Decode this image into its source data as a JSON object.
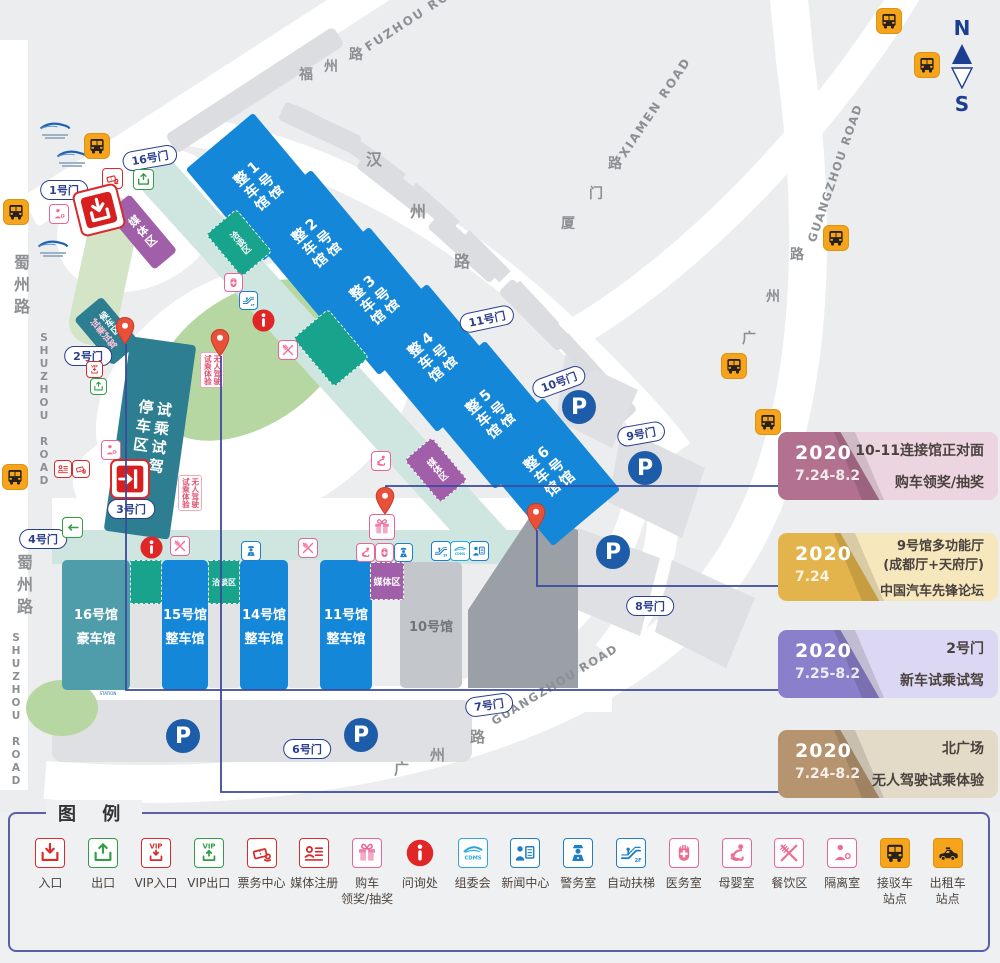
{
  "compass": {
    "n": "N",
    "s": "S"
  },
  "legend": {
    "title": "图 例",
    "items": [
      {
        "icon": "entrance",
        "label": "入口"
      },
      {
        "icon": "exit",
        "label": "出口"
      },
      {
        "icon": "vip-entrance",
        "label": "VIP入口"
      },
      {
        "icon": "vip-exit",
        "label": "VIP出口"
      },
      {
        "icon": "tickets",
        "label": "票务中心"
      },
      {
        "icon": "media-reg",
        "label": "媒体注册"
      },
      {
        "icon": "gift",
        "label": "购车\n领奖/抽奖"
      },
      {
        "icon": "info",
        "label": "问询处"
      },
      {
        "icon": "cdms",
        "label": "组委会"
      },
      {
        "icon": "news",
        "label": "新闻中心"
      },
      {
        "icon": "police",
        "label": "警务室"
      },
      {
        "icon": "escalator",
        "label": "自动扶梯"
      },
      {
        "icon": "medical",
        "label": "医务室"
      },
      {
        "icon": "mother-baby",
        "label": "母婴室"
      },
      {
        "icon": "dining",
        "label": "餐饮区"
      },
      {
        "icon": "isolation",
        "label": "隔离室"
      },
      {
        "icon": "shuttle-bus",
        "label": "接驳车\n站点"
      },
      {
        "icon": "taxi",
        "label": "出租车\n站点"
      }
    ]
  },
  "callouts": [
    {
      "year": "2020",
      "date": "7.24-8.2",
      "lines": [
        "10-11连接馆正对面",
        "购车领奖/抽奖"
      ],
      "dark": "#b1718f",
      "light": "#ecd4e1",
      "y": 432
    },
    {
      "year": "2020",
      "date": "7.24",
      "lines": [
        "9号馆多功能厅",
        "(成都厅+天府厅)",
        "中国汽车先锋论坛"
      ],
      "dark": "#e2b44b",
      "light": "#f7e7bd",
      "y": 533
    },
    {
      "year": "2020",
      "date": "7.25-8.2",
      "lines": [
        "2号门",
        "新车试乘试驾"
      ],
      "dark": "#8a7fca",
      "light": "#dcd7f2",
      "y": 630
    },
    {
      "year": "2020",
      "date": "7.24-8.2",
      "lines": [
        "北广场",
        "无人驾驶试乘体验"
      ],
      "dark": "#b5946f",
      "light": "#e4dac8",
      "y": 730
    }
  ],
  "map": {
    "roadLabels": [
      {
        "text": "FUZHOU ROAD",
        "x": 370,
        "y": 40,
        "rot": -33,
        "fs": 12,
        "ls": 2
      },
      {
        "text": "福",
        "x": 299,
        "y": 64,
        "fs": 14
      },
      {
        "text": "州",
        "x": 324,
        "y": 56,
        "fs": 14
      },
      {
        "text": "路",
        "x": 349,
        "y": 44,
        "fs": 14
      },
      {
        "text": "汉",
        "x": 366,
        "y": 146,
        "fs": 16
      },
      {
        "text": "州",
        "x": 410,
        "y": 198,
        "fs": 16
      },
      {
        "text": "路",
        "x": 454,
        "y": 248,
        "fs": 16
      },
      {
        "text": "厦",
        "x": 561,
        "y": 213,
        "fs": 14
      },
      {
        "text": "门",
        "x": 589,
        "y": 183,
        "fs": 14
      },
      {
        "text": "路",
        "x": 608,
        "y": 153,
        "fs": 14
      },
      {
        "text": "XIAMEN ROAD",
        "x": 628,
        "y": 146,
        "rot": -56,
        "fs": 12,
        "ls": 2
      },
      {
        "text": "路",
        "x": 790,
        "y": 244,
        "fs": 14
      },
      {
        "text": "州",
        "x": 766,
        "y": 286,
        "fs": 14
      },
      {
        "text": "广",
        "x": 742,
        "y": 328,
        "fs": 14
      },
      {
        "text": "GUANGZHOU ROAD",
        "x": 818,
        "y": 230,
        "rot": -71,
        "fs": 11.5,
        "ls": 1.5
      },
      {
        "text": "广",
        "x": 394,
        "y": 758,
        "fs": 15
      },
      {
        "text": "州",
        "x": 430,
        "y": 744,
        "fs": 15
      },
      {
        "text": "路",
        "x": 470,
        "y": 726,
        "fs": 15
      },
      {
        "text": "GUANGZHOU ROAD",
        "x": 496,
        "y": 714,
        "rot": -31,
        "fs": 11.5,
        "ls": 1.5
      },
      {
        "text": "蜀州路",
        "x": 8,
        "y": 254,
        "vertical": true,
        "fs": 16,
        "ls": 6
      },
      {
        "text": "SHUZHOU ROAD",
        "x": 38,
        "y": 332,
        "vertical": true,
        "upright": true,
        "fs": 10.5,
        "ls": 1
      },
      {
        "text": "蜀州路",
        "x": 11,
        "y": 554,
        "vertical": true,
        "fs": 16,
        "ls": 6
      },
      {
        "text": "SHUZHOU ROAD",
        "x": 10,
        "y": 632,
        "vertical": true,
        "upright": true,
        "fs": 10.5,
        "ls": 1
      }
    ],
    "gates": [
      {
        "label": "16号门",
        "x": 150,
        "y": 158,
        "rot": -10
      },
      {
        "label": "1号门",
        "x": 64,
        "y": 190,
        "rot": 0
      },
      {
        "label": "2号门",
        "x": 88,
        "y": 356,
        "rot": 0
      },
      {
        "label": "3号门",
        "x": 131,
        "y": 509,
        "rot": 0
      },
      {
        "label": "4号门",
        "x": 43,
        "y": 539,
        "rot": 0
      },
      {
        "label": "11号门",
        "x": 487,
        "y": 319,
        "rot": -12
      },
      {
        "label": "10号门",
        "x": 559,
        "y": 382,
        "rot": -20
      },
      {
        "label": "9号门",
        "x": 641,
        "y": 434,
        "rot": -10
      },
      {
        "label": "8号门",
        "x": 650,
        "y": 606,
        "rot": 0
      },
      {
        "label": "7号门",
        "x": 489,
        "y": 705,
        "rot": -8
      },
      {
        "label": "6号门",
        "x": 307,
        "y": 749,
        "rot": 0
      }
    ],
    "upperHalls": [
      {
        "name": "1号馆",
        "sub": "整车馆",
        "cx": 258,
        "cy": 187
      },
      {
        "name": "2号馆",
        "sub": "整车馆",
        "cx": 316,
        "cy": 244
      },
      {
        "name": "3号馆",
        "sub": "整车馆",
        "cx": 374,
        "cy": 301
      },
      {
        "name": "4号馆",
        "sub": "整车馆",
        "cx": 432,
        "cy": 358
      },
      {
        "name": "5号馆",
        "sub": "整车馆",
        "cx": 490,
        "cy": 415
      },
      {
        "name": "6号馆",
        "sub": "整车馆",
        "cx": 548,
        "cy": 472
      }
    ],
    "lowerHalls": [
      {
        "name": "16号馆",
        "sub": "豪车馆",
        "x": 62,
        "y": 560,
        "w": 68,
        "h": 130,
        "color": "#4f9dab"
      },
      {
        "name": "15号馆",
        "sub": "整车馆",
        "x": 162,
        "y": 560,
        "w": 46,
        "h": 130,
        "color": "#1587d8"
      },
      {
        "name": "14号馆",
        "sub": "整车馆",
        "x": 240,
        "y": 560,
        "w": 48,
        "h": 130,
        "color": "#1587d8"
      },
      {
        "name": "11号馆",
        "sub": "整车馆",
        "x": 320,
        "y": 560,
        "w": 52,
        "h": 130,
        "color": "#1587d8"
      },
      {
        "name": "10号馆",
        "sub": "",
        "x": 400,
        "y": 562,
        "w": 62,
        "h": 126,
        "color": "#c3c6ca",
        "tc": "#70757b"
      }
    ],
    "zones": [
      {
        "kind": "rot",
        "nm": "waiting-area",
        "cx": 107,
        "cy": 331,
        "w": 36,
        "h": 60,
        "rot": -40,
        "color": "#2e7e92",
        "cols": [
          "候车区",
          "试乘试驾"
        ],
        "colors": [
          "#ffffff",
          "#ffc2d6"
        ],
        "fs": 9
      },
      {
        "kind": "rot",
        "nm": "test-drive-parking",
        "cx": 150,
        "cy": 438,
        "w": 66,
        "h": 196,
        "rot": 8,
        "color": "#2e7e92",
        "cols": [
          "试乘试驾",
          "停车区"
        ],
        "fs": 15,
        "ls": 4
      },
      {
        "kind": "rot",
        "nm": "media-zone",
        "cx": 142,
        "cy": 232,
        "w": 30,
        "h": 74,
        "rot": -40,
        "color": "#a05fa8",
        "cols": [
          "媒体区"
        ],
        "fs": 11,
        "ls": 2
      },
      {
        "kind": "rot",
        "nm": "talks-zone",
        "cx": 239,
        "cy": 243,
        "w": 40,
        "h": 56,
        "rot": -40,
        "color": "#17a38c",
        "dashed": true,
        "cols": [
          "洽谈区"
        ],
        "fs": 9
      },
      {
        "kind": "rot",
        "nm": "talks-zone",
        "cx": 331,
        "cy": 348,
        "w": 46,
        "h": 64,
        "rot": -40,
        "color": "#17a38c",
        "dashed": true,
        "cols": [],
        "fs": 9
      },
      {
        "kind": "rot",
        "nm": "media-zone",
        "cx": 436,
        "cy": 470,
        "w": 36,
        "h": 56,
        "rot": -40,
        "color": "#a05fa8",
        "dashed": true,
        "cols": [
          "媒体区"
        ],
        "fs": 9
      },
      {
        "kind": "rect",
        "nm": "talks-zone",
        "x": 130,
        "y": 560,
        "w": 32,
        "h": 44,
        "color": "#17a38c",
        "dashed": true
      },
      {
        "kind": "rect",
        "nm": "hall-gap",
        "x": 130,
        "y": 604,
        "w": 32,
        "h": 84,
        "color": "#e2e3e5"
      },
      {
        "kind": "rect",
        "nm": "talks-zone",
        "x": 208,
        "y": 560,
        "w": 32,
        "h": 44,
        "color": "#17a38c",
        "dashed": true,
        "label": "洽谈区",
        "fs": 8
      },
      {
        "kind": "rect",
        "nm": "hall-gap",
        "x": 208,
        "y": 604,
        "w": 32,
        "h": 84,
        "color": "#e2e3e5"
      },
      {
        "kind": "rect",
        "nm": "hall-gap",
        "x": 288,
        "y": 560,
        "w": 32,
        "h": 128,
        "color": "#e2e3e5"
      },
      {
        "kind": "rect",
        "nm": "media-zone",
        "x": 370,
        "y": 562,
        "w": 34,
        "h": 38,
        "color": "#a05fa8",
        "dashed": true,
        "label": "媒体区",
        "fs": 9
      }
    ],
    "routeTags": [
      {
        "x": 200,
        "y": 352,
        "cols": [
          "无人驾驶",
          "试乘体验"
        ]
      },
      {
        "x": 178,
        "y": 475,
        "cols": [
          "无人驾驶",
          "试乘体验"
        ]
      }
    ],
    "pins": [
      {
        "x": 373,
        "y": 486
      },
      {
        "x": 524,
        "y": 502
      },
      {
        "x": 113,
        "y": 316
      },
      {
        "x": 208,
        "y": 328
      }
    ],
    "connectors": [
      [
        [
          386,
          512
        ],
        [
          386,
          486
        ],
        [
          784,
          486
        ]
      ],
      [
        [
          537,
          530
        ],
        [
          537,
          586
        ],
        [
          784,
          586
        ]
      ],
      [
        [
          126,
          344
        ],
        [
          126,
          690
        ],
        [
          784,
          690
        ]
      ],
      [
        [
          221,
          356
        ],
        [
          221,
          792
        ],
        [
          784,
          792
        ]
      ]
    ],
    "icons": [
      {
        "t": "tickets",
        "x": 102,
        "y": 168,
        "s": 21
      },
      {
        "t": "exit",
        "x": 133,
        "y": 169,
        "s": 21
      },
      {
        "t": "isolation",
        "x": 49,
        "y": 204,
        "s": 20
      },
      {
        "t": "big-entrance",
        "x": 76,
        "y": 187,
        "s": 46,
        "rot": -14
      },
      {
        "t": "medical",
        "x": 224,
        "y": 273,
        "s": 19
      },
      {
        "t": "escalator",
        "x": 239,
        "y": 291,
        "s": 19
      },
      {
        "t": "info",
        "x": 251,
        "y": 308,
        "s": 25
      },
      {
        "t": "dining",
        "x": 278,
        "y": 340,
        "s": 20
      },
      {
        "t": "vip-entrance",
        "x": 86,
        "y": 361,
        "s": 17
      },
      {
        "t": "exit",
        "x": 90,
        "y": 378,
        "s": 17
      },
      {
        "t": "mother-baby",
        "x": 371,
        "y": 451,
        "s": 20
      },
      {
        "t": "isolation",
        "x": 101,
        "y": 440,
        "s": 20
      },
      {
        "t": "media-reg",
        "x": 54,
        "y": 460,
        "s": 18
      },
      {
        "t": "tickets",
        "x": 72,
        "y": 460,
        "s": 18
      },
      {
        "t": "big-entrance-door",
        "x": 110,
        "y": 459,
        "s": 40
      },
      {
        "t": "exit-left",
        "x": 62,
        "y": 517,
        "s": 21
      },
      {
        "t": "gift",
        "x": 369,
        "y": 514,
        "s": 26
      },
      {
        "t": "info",
        "x": 139,
        "y": 535,
        "s": 25
      },
      {
        "t": "dining",
        "x": 170,
        "y": 536,
        "s": 20
      },
      {
        "t": "police",
        "x": 241,
        "y": 541,
        "s": 20
      },
      {
        "t": "dining",
        "x": 298,
        "y": 538,
        "s": 20
      },
      {
        "t": "mother-baby",
        "x": 356,
        "y": 543,
        "s": 19
      },
      {
        "t": "medical",
        "x": 375,
        "y": 543,
        "s": 19
      },
      {
        "t": "police",
        "x": 394,
        "y": 543,
        "s": 19
      },
      {
        "t": "escalator",
        "x": 431,
        "y": 541,
        "s": 20
      },
      {
        "t": "cdms",
        "x": 450,
        "y": 541,
        "s": 20
      },
      {
        "t": "news",
        "x": 469,
        "y": 541,
        "s": 20
      }
    ],
    "parking": [
      {
        "x": 562,
        "y": 390
      },
      {
        "x": 628,
        "y": 451
      },
      {
        "x": 596,
        "y": 535
      },
      {
        "x": 166,
        "y": 719
      },
      {
        "x": 344,
        "y": 718
      }
    ],
    "busStops": [
      {
        "x": 84,
        "y": 133
      },
      {
        "x": 3,
        "y": 199
      },
      {
        "x": 2,
        "y": 464
      },
      {
        "x": 876,
        "y": 8
      },
      {
        "x": 914,
        "y": 52
      },
      {
        "x": 823,
        "y": 225
      },
      {
        "x": 721,
        "y": 353
      },
      {
        "x": 755,
        "y": 409
      }
    ],
    "stations": [
      {
        "x": 27,
        "y": 120,
        "label": "",
        "sub": ""
      },
      {
        "x": 44,
        "y": 148,
        "label": "",
        "sub": ""
      },
      {
        "x": 25,
        "y": 238,
        "label": "",
        "sub": ""
      },
      {
        "x": 80,
        "y": 586,
        "label": "广州路站",
        "sub": "GUANGZHOU ROAD STATION"
      },
      {
        "x": 80,
        "y": 668,
        "label": "广州路站",
        "sub": "GUANGZHOU ROAD STATION"
      }
    ]
  }
}
